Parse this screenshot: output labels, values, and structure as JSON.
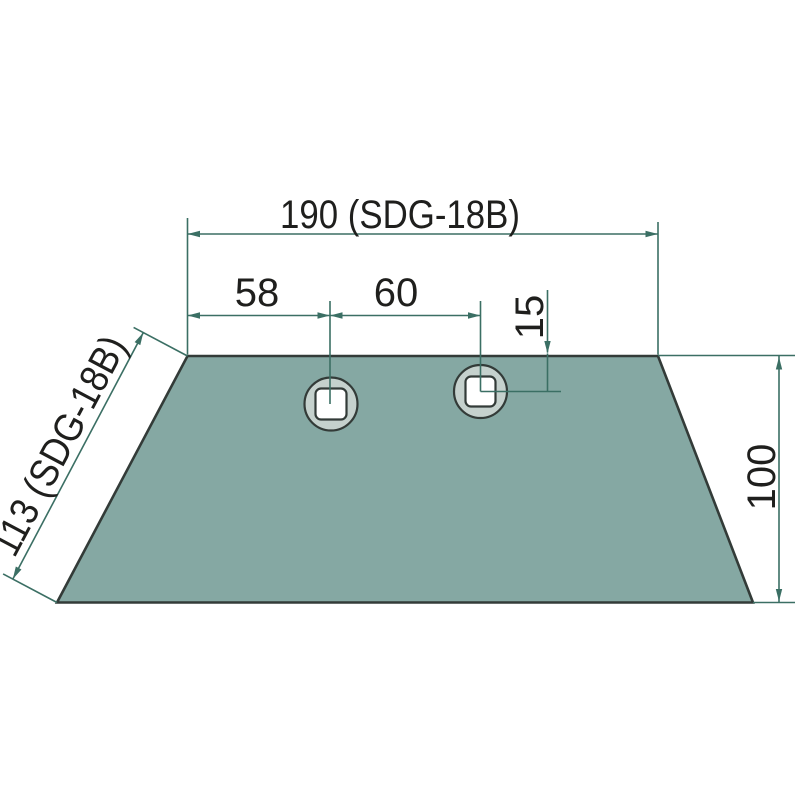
{
  "colors": {
    "background": "#ffffff",
    "part-fill": "#85a8a3",
    "part-outline": "#333b38",
    "hole-ring-fill": "#c5d1cd",
    "bolt-hole-fill": "#ffffff",
    "dimension-line": "#3b6f64",
    "label-text": "#1f1f1d"
  },
  "drawing": {
    "labels": {
      "top_width": "190 (SDG-18B)",
      "hole_offset_left": "58",
      "hole_spacing": "60",
      "hole_center_from_edge": "15",
      "left_edge_length": "113 (SDG-18B)",
      "right_height": "100"
    }
  }
}
